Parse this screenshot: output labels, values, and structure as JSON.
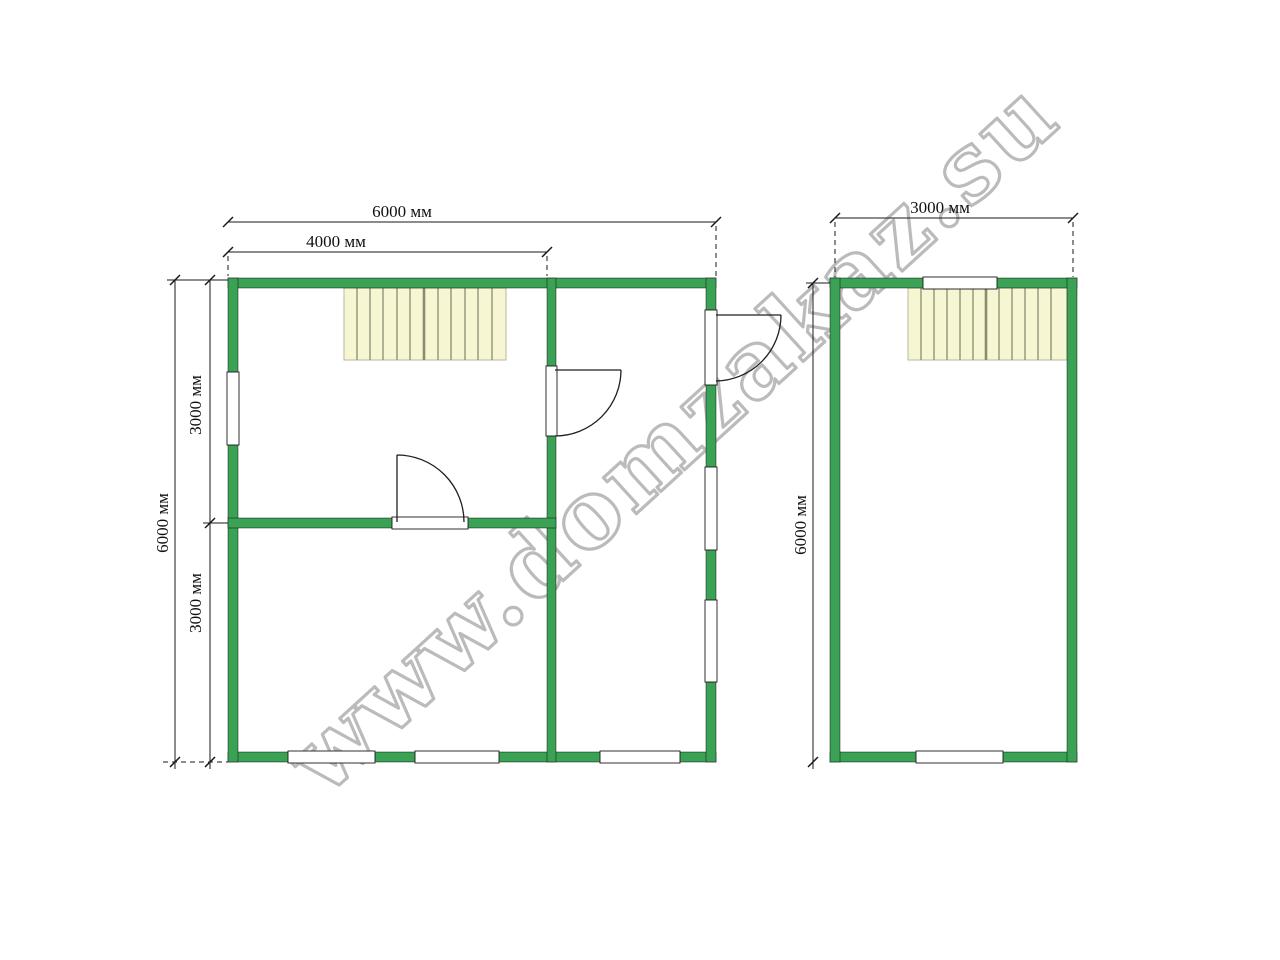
{
  "watermark": {
    "text": "www.domzakaz.su"
  },
  "left_plan": {
    "dim_width_total": "6000 мм",
    "dim_width_partial": "4000 мм",
    "dim_height_total": "6000 мм",
    "dim_height_upper": "3000 мм",
    "dim_height_lower": "3000 мм"
  },
  "right_plan": {
    "dim_width_total": "3000 мм",
    "dim_height_total": "6000 мм"
  },
  "colors": {
    "wall_green": "#3aa155",
    "stairs_fill": "#f6f6d2",
    "stairs_tread_line": "#8b8b70",
    "dimension_black": "#1a1a1a",
    "watermark_grey": "#ababab",
    "window_white": "#ffffff"
  }
}
